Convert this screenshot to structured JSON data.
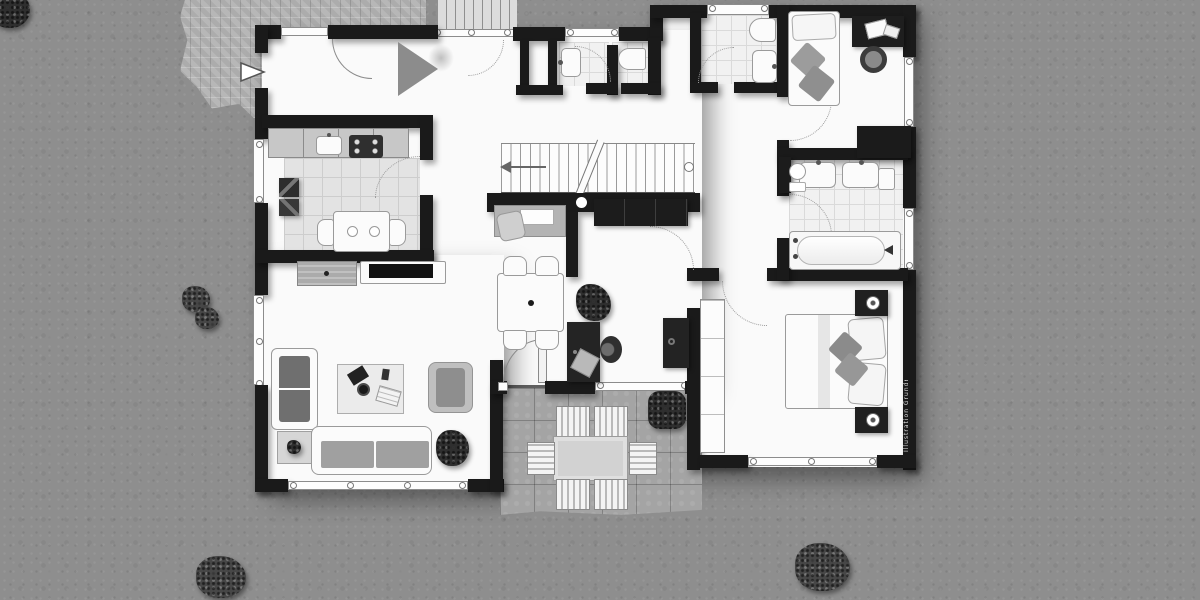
{
  "watermark": {
    "text": "Illustration Grundriss"
  },
  "palette": {
    "lawn": "#8e8e8e",
    "paving": "#b7b7b7",
    "terrace": "#a4a4a4",
    "walls": "#1a1a1a",
    "floor": "#fafafa",
    "tiles": "#f1f1f1",
    "dark_furniture": "#222222",
    "light_furniture": "#fbfbfb"
  },
  "inventory": {
    "outdoor": [
      "lawn",
      "paved-path",
      "terrace",
      "bushes",
      "exterior-stair"
    ],
    "rooms": [
      "entrance-hall",
      "kitchen",
      "storage-niche",
      "shower-room",
      "wc",
      "upper-bathroom",
      "small-bedroom",
      "ensuite-bathroom",
      "hallway",
      "staircase",
      "dining-area",
      "office-nook",
      "living-room",
      "master-bedroom"
    ],
    "kitchen": [
      "counter",
      "sink",
      "stove",
      "table",
      "two-chairs",
      "wall-art"
    ],
    "living_room": [
      "two-seat-sofa",
      "three-seat-sofa",
      "armchair",
      "coffee-table",
      "side-table",
      "tv-console",
      "sideboard",
      "plants"
    ],
    "master_bedroom": [
      "double-bed",
      "pillows",
      "two-nightstands",
      "lamps",
      "built-in-wardrobe"
    ],
    "small_bedroom": [
      "single-bed",
      "desk",
      "desk-chair"
    ],
    "ensuite_bathroom": [
      "double-sink",
      "wall-toilet",
      "bathtub",
      "dark-wardrobe"
    ],
    "terrace": [
      "outdoor-table",
      "six-slatted-chairs",
      "bush"
    ]
  }
}
